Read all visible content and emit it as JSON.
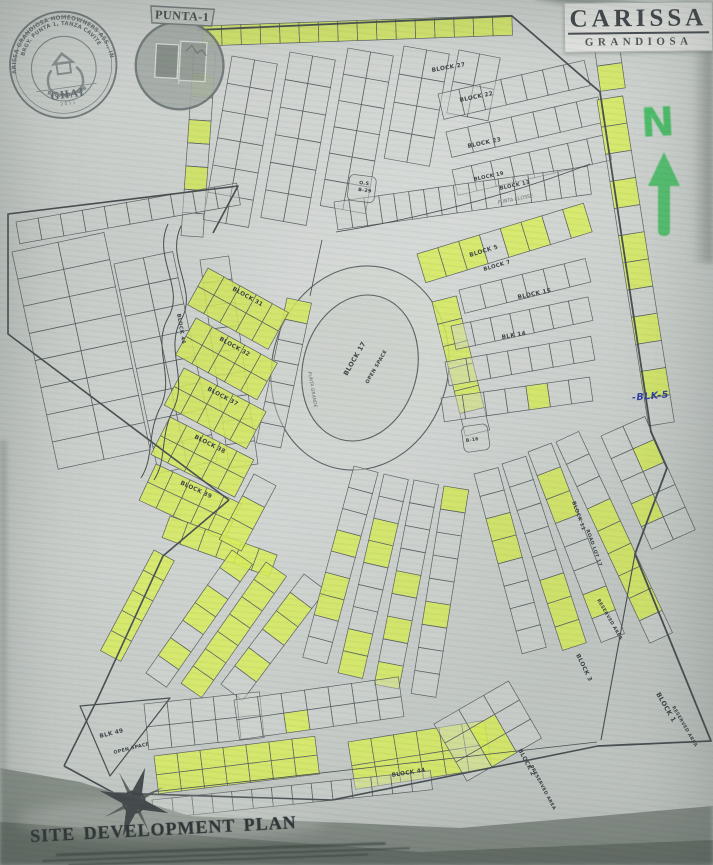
{
  "title_block": {
    "title": "CARISSA",
    "subtitle": "GRANDIOSA"
  },
  "seals": {
    "ghai": {
      "arc_outer": "CARISSA GRANDIOSA HOMEOWNERS ASS., INC.",
      "arc_inner": "BRGY. PUNTA 1, TANZA CAVITE",
      "arc_bottom": "REG. NO. 1486",
      "acronym": "GHAI",
      "year": "2011"
    },
    "punta": {
      "banner": "PUNTA-1"
    }
  },
  "annotations": {
    "north_label": "N",
    "handwritten_note": "-BLK-5"
  },
  "footer": {
    "plan_title": "SITE DEVELOPMENT PLAN"
  },
  "colors": {
    "paper": "#ced2cf",
    "lot_fill": "#d3d7d3",
    "lot_line": "#596062",
    "boundary": "#454d4f",
    "highlight": "#d9ef59",
    "marker_green": "#41bd60",
    "pen_blue": "#3240a2",
    "label_ink": "#3a4244"
  },
  "map": {
    "ellipses": [
      {
        "cx": 360,
        "cy": 368,
        "rx": 88,
        "ry": 103,
        "rot": 15,
        "fill": "#d6dad5"
      },
      {
        "cx": 360,
        "cy": 368,
        "rx": 57,
        "ry": 74,
        "rot": 15,
        "fill": "#d2d6d1"
      }
    ],
    "strips": [
      {
        "x": 202,
        "y": 26,
        "w": 310,
        "h": 20,
        "rot": -2,
        "rows": 1,
        "cols": 16,
        "hl": "all"
      },
      {
        "x": 194,
        "y": 50,
        "w": 22,
        "h": 186,
        "rot": 4,
        "rows": 8,
        "cols": 1,
        "hl": [
          1,
          3,
          5
        ]
      },
      {
        "x": 232,
        "y": 56,
        "w": 46,
        "h": 166,
        "rot": 10,
        "rows": 6,
        "cols": 2,
        "hl": []
      },
      {
        "x": 290,
        "y": 52,
        "w": 46,
        "h": 168,
        "rot": 10,
        "rows": 6,
        "cols": 2,
        "hl": []
      },
      {
        "x": 348,
        "y": 48,
        "w": 46,
        "h": 160,
        "rot": 10,
        "rows": 6,
        "cols": 2,
        "hl": []
      },
      {
        "x": 404,
        "y": 46,
        "w": 46,
        "h": 114,
        "rot": 10,
        "rows": 4,
        "cols": 2,
        "hl": []
      },
      {
        "x": 459,
        "y": 50,
        "w": 42,
        "h": 64,
        "rot": 11,
        "rows": 2,
        "cols": 2,
        "hl": []
      },
      {
        "x": 438,
        "y": 94,
        "w": 150,
        "h": 26,
        "rot": -13,
        "rows": 1,
        "cols": 7,
        "hl": []
      },
      {
        "x": 446,
        "y": 132,
        "w": 156,
        "h": 26,
        "rot": -13,
        "rows": 1,
        "cols": 7,
        "hl": []
      },
      {
        "x": 452,
        "y": 170,
        "w": 158,
        "h": 26,
        "rot": -13,
        "rows": 1,
        "cols": 8,
        "hl": []
      },
      {
        "x": 334,
        "y": 202,
        "w": 256,
        "h": 28,
        "rot": -8,
        "rows": 1,
        "cols": 17,
        "hl": []
      },
      {
        "x": 590,
        "y": 16,
        "w": 25,
        "h": 76,
        "rot": -8,
        "rows": 3,
        "cols": 1,
        "hl": [
          0,
          2
        ]
      },
      {
        "x": 597,
        "y": 100,
        "w": 26,
        "h": 330,
        "rot": -9,
        "rows": 12,
        "cols": 1,
        "hl": [
          0,
          1,
          3,
          5,
          6,
          8,
          10
        ]
      },
      {
        "x": 601,
        "y": 436,
        "w": 48,
        "h": 124,
        "rot": -24,
        "rows": 5,
        "cols": 2,
        "hl": [
          3,
          6
        ]
      },
      {
        "x": 287,
        "y": 298,
        "w": 25,
        "h": 148,
        "rot": 12,
        "rows": 7,
        "cols": 1,
        "hl": [
          0
        ]
      },
      {
        "x": 432,
        "y": 302,
        "w": 25,
        "h": 138,
        "rot": -14,
        "rows": 6,
        "cols": 1,
        "hl": [
          0,
          1,
          2,
          3,
          4
        ]
      },
      {
        "x": 417,
        "y": 254,
        "w": 174,
        "h": 30,
        "rot": -17,
        "rows": 1,
        "cols": 8,
        "hl": [
          0,
          1,
          2,
          4,
          5,
          7
        ]
      },
      {
        "x": 459,
        "y": 290,
        "w": 130,
        "h": 24,
        "rot": -14,
        "rows": 1,
        "cols": 6,
        "hl": []
      },
      {
        "x": 451,
        "y": 326,
        "w": 140,
        "h": 24,
        "rot": -12,
        "rows": 1,
        "cols": 7,
        "hl": []
      },
      {
        "x": 445,
        "y": 362,
        "w": 148,
        "h": 24,
        "rot": -10,
        "rows": 1,
        "cols": 7,
        "hl": []
      },
      {
        "x": 441,
        "y": 398,
        "w": 150,
        "h": 24,
        "rot": -8,
        "rows": 1,
        "cols": 7,
        "hl": [
          4
        ]
      },
      {
        "x": 16,
        "y": 222,
        "w": 224,
        "h": 22,
        "rot": -10,
        "rows": 1,
        "cols": 10,
        "hl": []
      },
      {
        "x": 12,
        "y": 252,
        "w": 94,
        "h": 222,
        "rot": -12,
        "rows": 8,
        "cols": 2,
        "hl": []
      },
      {
        "x": 114,
        "y": 264,
        "w": 60,
        "h": 214,
        "rot": -12,
        "rows": 8,
        "cols": 2,
        "hl": []
      },
      {
        "x": 200,
        "y": 260,
        "w": 29,
        "h": 210,
        "rot": -8,
        "rows": 9,
        "cols": 1,
        "hl": []
      },
      {
        "x": 208,
        "y": 268,
        "w": 92,
        "h": 42,
        "rot": 29,
        "rows": 2,
        "cols": 5,
        "hl": "all"
      },
      {
        "x": 196,
        "y": 318,
        "w": 93,
        "h": 42,
        "rot": 29,
        "rows": 2,
        "cols": 5,
        "hl": "all"
      },
      {
        "x": 184,
        "y": 368,
        "w": 93,
        "h": 42,
        "rot": 28,
        "rows": 2,
        "cols": 5,
        "hl": "all"
      },
      {
        "x": 170,
        "y": 417,
        "w": 94,
        "h": 42,
        "rot": 27,
        "rows": 2,
        "cols": 5,
        "hl": "all"
      },
      {
        "x": 156,
        "y": 464,
        "w": 94,
        "h": 40,
        "rot": 25,
        "rows": 2,
        "cols": 5,
        "hl": "all"
      },
      {
        "x": 170,
        "y": 516,
        "w": 114,
        "h": 23,
        "rot": 20,
        "rows": 1,
        "cols": 6,
        "hl": "all"
      },
      {
        "x": 154,
        "y": 550,
        "w": 23,
        "h": 114,
        "rot": 28,
        "rows": 5,
        "cols": 1,
        "hl": "all"
      },
      {
        "x": 232,
        "y": 550,
        "w": 25,
        "h": 150,
        "rot": 35,
        "rows": 7,
        "cols": 1,
        "hl": [
          0,
          2,
          3,
          5
        ]
      },
      {
        "x": 266,
        "y": 562,
        "w": 25,
        "h": 148,
        "rot": 35,
        "rows": 7,
        "cols": 1,
        "hl": "all"
      },
      {
        "x": 304,
        "y": 574,
        "w": 27,
        "h": 138,
        "rot": 37,
        "rows": 6,
        "cols": 1,
        "hl": [
          1,
          2,
          4
        ]
      },
      {
        "x": 254,
        "y": 474,
        "w": 25,
        "h": 74,
        "rot": 28,
        "rows": 3,
        "cols": 1,
        "hl": [
          1,
          2
        ]
      },
      {
        "x": 354,
        "y": 466,
        "w": 25,
        "h": 198,
        "rot": 15,
        "rows": 9,
        "cols": 1,
        "hl": [
          3,
          5,
          6
        ]
      },
      {
        "x": 384,
        "y": 474,
        "w": 25,
        "h": 204,
        "rot": 13,
        "rows": 9,
        "cols": 1,
        "hl": [
          2,
          3,
          7,
          8
        ]
      },
      {
        "x": 414,
        "y": 480,
        "w": 25,
        "h": 208,
        "rot": 11,
        "rows": 9,
        "cols": 1,
        "hl": [
          4,
          6,
          8
        ]
      },
      {
        "x": 444,
        "y": 486,
        "w": 25,
        "h": 210,
        "rot": 9,
        "rows": 9,
        "cols": 1,
        "hl": [
          0,
          5
        ]
      },
      {
        "x": 474,
        "y": 474,
        "w": 25,
        "h": 186,
        "rot": -15,
        "rows": 8,
        "cols": 1,
        "hl": [
          2,
          3
        ]
      },
      {
        "x": 502,
        "y": 464,
        "w": 25,
        "h": 196,
        "rot": -18,
        "rows": 8,
        "cols": 1,
        "hl": [
          5,
          6,
          7
        ]
      },
      {
        "x": 528,
        "y": 452,
        "w": 25,
        "h": 204,
        "rot": -21,
        "rows": 8,
        "cols": 1,
        "hl": [
          1,
          2,
          6
        ]
      },
      {
        "x": 556,
        "y": 442,
        "w": 25,
        "h": 222,
        "rot": -25,
        "rows": 9,
        "cols": 1,
        "hl": [
          3,
          4,
          5,
          6,
          7
        ]
      },
      {
        "x": 144,
        "y": 704,
        "w": 116,
        "h": 46,
        "rot": -6,
        "rows": 2,
        "cols": 5,
        "hl": []
      },
      {
        "x": 234,
        "y": 700,
        "w": 166,
        "h": 40,
        "rot": -8,
        "rows": 2,
        "cols": 7,
        "hl": [
          9
        ]
      },
      {
        "x": 154,
        "y": 756,
        "w": 162,
        "h": 38,
        "rot": -7,
        "rows": 2,
        "cols": 7,
        "hl": "all"
      },
      {
        "x": 348,
        "y": 742,
        "w": 138,
        "h": 48,
        "rot": -9,
        "rows": 2,
        "cols": 6,
        "hl": "all"
      },
      {
        "x": 152,
        "y": 800,
        "w": 280,
        "h": 19,
        "rot": -6,
        "rows": 1,
        "cols": 14,
        "hl": []
      },
      {
        "x": 434,
        "y": 724,
        "w": 86,
        "h": 66,
        "rot": -30,
        "rows": 3,
        "cols": 3,
        "hl": [
          4,
          7
        ]
      },
      {
        "x": 350,
        "y": 174,
        "w": 27,
        "h": 26,
        "rot": 7,
        "rows": 1,
        "cols": 1,
        "hl": [],
        "rx": 5
      },
      {
        "x": 461,
        "y": 427,
        "w": 26,
        "h": 26,
        "rot": -8,
        "rows": 1,
        "cols": 1,
        "hl": [],
        "rx": 5
      }
    ],
    "paths": [
      {
        "d": "M197,30 L512,16 L600,92 L651,432 L667,468 L635,554 L711,741 L598,746",
        "w": 1.8
      },
      {
        "d": "M598,746 L332,800 L114,793 L64,766",
        "w": 1.6
      },
      {
        "d": "M64,766 L97,700 L163,556 L229,500",
        "w": 1.6
      },
      {
        "d": "M229,500 L8,334 L8,214 L238,186 L213,233",
        "w": 1.6
      },
      {
        "d": "M635,554 L601,740",
        "w": 1.1
      },
      {
        "d": "M168,224 C152,258 186,288 168,318 C151,348 177,378 159,410 C147,436 154,458 141,478",
        "w": 1,
        "n": "creek-line"
      },
      {
        "d": "M181,226 C165,260 199,290 181,320 C164,350 190,380 172,412 C160,438 167,460 154,480",
        "w": 1,
        "n": "creek-line"
      },
      {
        "d": "M336,232 Q470,210 590,164",
        "w": 0.8,
        "n": "road-line"
      },
      {
        "d": "M152,792 L597,742",
        "w": 0.8,
        "n": "road-line"
      },
      {
        "d": "M80,706 L170,698 L110,776 Z",
        "w": 1.2,
        "n": "open-space-triangle"
      },
      {
        "d": "M322,240 L310,296",
        "w": 0.8,
        "n": "road-line"
      }
    ],
    "labels": [
      {
        "t": "BLOCK 27",
        "x": 432,
        "y": 72,
        "r": -10,
        "k": "b"
      },
      {
        "t": "BLOCK 22",
        "x": 460,
        "y": 102,
        "r": -12,
        "k": "b"
      },
      {
        "t": "BLOCK 23",
        "x": 468,
        "y": 148,
        "r": -12,
        "k": "b"
      },
      {
        "t": "BLOCK 19",
        "x": 474,
        "y": 181,
        "r": -12,
        "s": 5.2,
        "k": "b"
      },
      {
        "t": "BLOCK 13",
        "x": 500,
        "y": 190,
        "r": -12,
        "s": 5.2,
        "k": "b"
      },
      {
        "t": "O.S",
        "x": 359,
        "y": 184,
        "r": 7,
        "s": 4.8,
        "k": "b"
      },
      {
        "t": "B-29",
        "x": 358,
        "y": 191,
        "r": 7,
        "s": 4.8,
        "k": "b"
      },
      {
        "t": "PUNTA CLOSSE",
        "x": 498,
        "y": 204,
        "r": -11,
        "s": 4.8,
        "k": "s"
      },
      {
        "t": "BLOCK 5",
        "x": 470,
        "y": 257,
        "r": -17,
        "k": "b"
      },
      {
        "t": "BLOCK 7",
        "x": 484,
        "y": 271,
        "r": -16,
        "s": 5.4,
        "k": "b"
      },
      {
        "t": "BLOCK 15",
        "x": 518,
        "y": 299,
        "r": -12,
        "k": "b"
      },
      {
        "t": "BLK 14",
        "x": 502,
        "y": 339,
        "r": -10,
        "k": "b"
      },
      {
        "t": "B-16",
        "x": 466,
        "y": 442,
        "r": -8,
        "s": 4.6,
        "k": "b"
      },
      {
        "t": "BLOCK 11",
        "x": 572,
        "y": 502,
        "r": 70,
        "s": 5.2,
        "k": "b"
      },
      {
        "t": "ROAD LOT 17",
        "x": 586,
        "y": 530,
        "r": 70,
        "s": 4.8,
        "k": "b"
      },
      {
        "t": "BLOCK 17",
        "x": 347,
        "y": 376,
        "r": -60,
        "s": 6.5,
        "k": "b"
      },
      {
        "t": "OPEN SPACE",
        "x": 368,
        "y": 384,
        "r": -60,
        "s": 5,
        "k": "b"
      },
      {
        "t": "BLOCK 46",
        "x": 177,
        "y": 314,
        "r": 80,
        "s": 5.2,
        "k": "b"
      },
      {
        "t": "BLOCK 31",
        "x": 232,
        "y": 290,
        "r": 29,
        "k": "b"
      },
      {
        "t": "BLOCK 32",
        "x": 219,
        "y": 340,
        "r": 29,
        "k": "b"
      },
      {
        "t": "BLOCK 37",
        "x": 207,
        "y": 390,
        "r": 28,
        "k": "b"
      },
      {
        "t": "BLOCK 38",
        "x": 194,
        "y": 438,
        "r": 27,
        "k": "b"
      },
      {
        "t": "BLOCK 39",
        "x": 180,
        "y": 484,
        "r": 25,
        "k": "b"
      },
      {
        "t": "PUNTA GRANDE",
        "x": 308,
        "y": 372,
        "r": 80,
        "s": 4.6,
        "k": "s"
      },
      {
        "t": "BLOCK 44",
        "x": 392,
        "y": 777,
        "r": -9,
        "k": "b"
      },
      {
        "t": "BLOCK 2",
        "x": 518,
        "y": 750,
        "r": 62,
        "k": "b"
      },
      {
        "t": "PRESERVED AREA",
        "x": 530,
        "y": 766,
        "r": 62,
        "s": 4.6,
        "k": "b"
      },
      {
        "t": "BLOCK 3",
        "x": 576,
        "y": 655,
        "r": 64,
        "k": "b"
      },
      {
        "t": "RESERVED AREA",
        "x": 597,
        "y": 600,
        "r": 60,
        "s": 4.6,
        "k": "b"
      },
      {
        "t": "BLOCK 1",
        "x": 656,
        "y": 694,
        "r": 60,
        "s": 6.5,
        "k": "b"
      },
      {
        "t": "RESERVED AREA",
        "x": 672,
        "y": 707,
        "r": 60,
        "s": 4.6,
        "k": "b"
      },
      {
        "t": "BLK 49",
        "x": 100,
        "y": 738,
        "r": -14,
        "k": "b"
      },
      {
        "t": "OPEN SPACE",
        "x": 114,
        "y": 754,
        "r": -14,
        "s": 4.8,
        "k": "b"
      }
    ]
  }
}
